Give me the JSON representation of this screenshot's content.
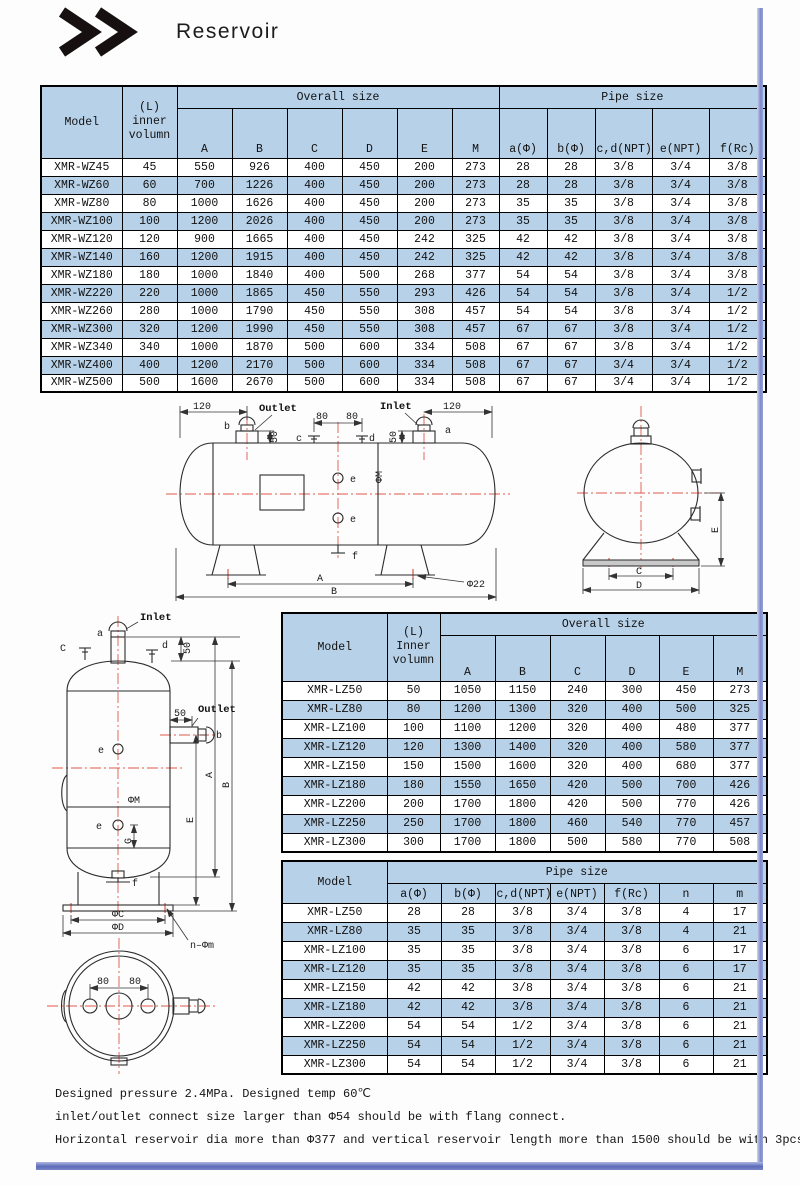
{
  "page": {
    "title": "Reservoir"
  },
  "colors": {
    "table_blue": "#b7d1e8",
    "centerline_red": "#e2584a",
    "page_border": "#6a77c1"
  },
  "table_wz": {
    "model_label": "Model",
    "volume_label": "(L)\ninner\nvolumn",
    "overall_label": "Overall size",
    "pipe_label": "Pipe size",
    "cols": [
      "A",
      "B",
      "C",
      "D",
      "E",
      "M",
      "a(Φ)",
      "b(Φ)",
      "c,d(NPT)",
      "e(NPT)",
      "f(Rc)"
    ],
    "rows": [
      [
        "XMR-WZ45",
        "45",
        "550",
        "926",
        "400",
        "450",
        "200",
        "273",
        "28",
        "28",
        "3/8",
        "3/4",
        "3/8"
      ],
      [
        "XMR-WZ60",
        "60",
        "700",
        "1226",
        "400",
        "450",
        "200",
        "273",
        "28",
        "28",
        "3/8",
        "3/4",
        "3/8"
      ],
      [
        "XMR-WZ80",
        "80",
        "1000",
        "1626",
        "400",
        "450",
        "200",
        "273",
        "35",
        "35",
        "3/8",
        "3/4",
        "3/8"
      ],
      [
        "XMR-WZ100",
        "100",
        "1200",
        "2026",
        "400",
        "450",
        "200",
        "273",
        "35",
        "35",
        "3/8",
        "3/4",
        "3/8"
      ],
      [
        "XMR-WZ120",
        "120",
        "900",
        "1665",
        "400",
        "450",
        "242",
        "325",
        "42",
        "42",
        "3/8",
        "3/4",
        "3/8"
      ],
      [
        "XMR-WZ140",
        "160",
        "1200",
        "1915",
        "400",
        "450",
        "242",
        "325",
        "42",
        "42",
        "3/8",
        "3/4",
        "3/8"
      ],
      [
        "XMR-WZ180",
        "180",
        "1000",
        "1840",
        "400",
        "500",
        "268",
        "377",
        "54",
        "54",
        "3/8",
        "3/4",
        "3/8"
      ],
      [
        "XMR-WZ220",
        "220",
        "1000",
        "1865",
        "450",
        "550",
        "293",
        "426",
        "54",
        "54",
        "3/8",
        "3/4",
        "1/2"
      ],
      [
        "XMR-WZ260",
        "280",
        "1000",
        "1790",
        "450",
        "550",
        "308",
        "457",
        "54",
        "54",
        "3/8",
        "3/4",
        "1/2"
      ],
      [
        "XMR-WZ300",
        "320",
        "1200",
        "1990",
        "450",
        "550",
        "308",
        "457",
        "67",
        "67",
        "3/8",
        "3/4",
        "1/2"
      ],
      [
        "XMR-WZ340",
        "340",
        "1000",
        "1870",
        "500",
        "600",
        "334",
        "508",
        "67",
        "67",
        "3/8",
        "3/4",
        "1/2"
      ],
      [
        "XMR-WZ400",
        "400",
        "1200",
        "2170",
        "500",
        "600",
        "334",
        "508",
        "67",
        "67",
        "3/4",
        "3/4",
        "1/2"
      ],
      [
        "XMR-WZ500",
        "500",
        "1600",
        "2670",
        "500",
        "600",
        "334",
        "508",
        "67",
        "67",
        "3/4",
        "3/4",
        "1/2"
      ]
    ]
  },
  "table_lz_overall": {
    "model_label": "Model",
    "volume_label": "(L)\nInner\nvolumn",
    "overall_label": "Overall size",
    "cols": [
      "A",
      "B",
      "C",
      "D",
      "E",
      "M"
    ],
    "rows": [
      [
        "XMR-LZ50",
        "50",
        "1050",
        "1150",
        "240",
        "300",
        "450",
        "273"
      ],
      [
        "XMR-LZ80",
        "80",
        "1200",
        "1300",
        "320",
        "400",
        "500",
        "325"
      ],
      [
        "XMR-LZ100",
        "100",
        "1100",
        "1200",
        "320",
        "400",
        "480",
        "377"
      ],
      [
        "XMR-LZ120",
        "120",
        "1300",
        "1400",
        "320",
        "400",
        "580",
        "377"
      ],
      [
        "XMR-LZ150",
        "150",
        "1500",
        "1600",
        "320",
        "400",
        "680",
        "377"
      ],
      [
        "XMR-LZ180",
        "180",
        "1550",
        "1650",
        "420",
        "500",
        "700",
        "426"
      ],
      [
        "XMR-LZ200",
        "200",
        "1700",
        "1800",
        "420",
        "500",
        "770",
        "426"
      ],
      [
        "XMR-LZ250",
        "250",
        "1700",
        "1800",
        "460",
        "540",
        "770",
        "457"
      ],
      [
        "XMR-LZ300",
        "300",
        "1700",
        "1800",
        "500",
        "580",
        "770",
        "508"
      ]
    ]
  },
  "table_lz_pipe": {
    "model_label": "Model",
    "pipe_label": "Pipe size",
    "cols": [
      "a(Φ)",
      "b(Φ)",
      "c,d(NPT)",
      "e(NPT)",
      "f(Rc)",
      "n",
      "m"
    ],
    "rows": [
      [
        "XMR-LZ50",
        "28",
        "28",
        "3/8",
        "3/4",
        "3/8",
        "4",
        "17"
      ],
      [
        "XMR-LZ80",
        "35",
        "35",
        "3/8",
        "3/4",
        "3/8",
        "4",
        "21"
      ],
      [
        "XMR-LZ100",
        "35",
        "35",
        "3/8",
        "3/4",
        "3/8",
        "6",
        "17"
      ],
      [
        "XMR-LZ120",
        "35",
        "35",
        "3/8",
        "3/4",
        "3/8",
        "6",
        "17"
      ],
      [
        "XMR-LZ150",
        "42",
        "42",
        "3/8",
        "3/4",
        "3/8",
        "6",
        "21"
      ],
      [
        "XMR-LZ180",
        "42",
        "42",
        "3/8",
        "3/4",
        "3/8",
        "6",
        "21"
      ],
      [
        "XMR-LZ200",
        "54",
        "54",
        "1/2",
        "3/4",
        "3/8",
        "6",
        "21"
      ],
      [
        "XMR-LZ250",
        "54",
        "54",
        "1/2",
        "3/4",
        "3/8",
        "6",
        "21"
      ],
      [
        "XMR-LZ300",
        "54",
        "54",
        "1/2",
        "3/4",
        "3/8",
        "6",
        "21"
      ]
    ]
  },
  "drawings": {
    "h": {
      "outlet": "Outlet",
      "inlet": "Inlet",
      "a": "a",
      "b": "b",
      "c": "c",
      "d": "d",
      "e": "e",
      "f": "f",
      "d120": "120",
      "d80": "80",
      "d50": "50",
      "A": "A",
      "B": "B",
      "phi22": "Φ22",
      "phiM": "ΦM"
    },
    "end": {
      "C": "C",
      "D": "D",
      "E": "E"
    },
    "v": {
      "inlet": "Inlet",
      "outlet": "Outlet",
      "a": "a",
      "b": "b",
      "c": "C",
      "d": "d",
      "e": "e",
      "f": "f",
      "G": "G",
      "d50": "50",
      "A": "A",
      "B": "B",
      "E": "E",
      "phiM": "ΦM",
      "phiC": "ΦC",
      "phiD": "ΦD",
      "nphim": "n–Φm"
    },
    "t": {
      "d80": "80"
    }
  },
  "footer": {
    "lines": [
      "Designed pressure 2.4MPa. Designed temp 60℃",
      "inlet/outlet connect size larger than Φ54 should be with flang connect.",
      "Horizontal reservoir dia more than Φ377 and vertical reservoir length more than 1500 should be with 3pcs level glass."
    ]
  }
}
